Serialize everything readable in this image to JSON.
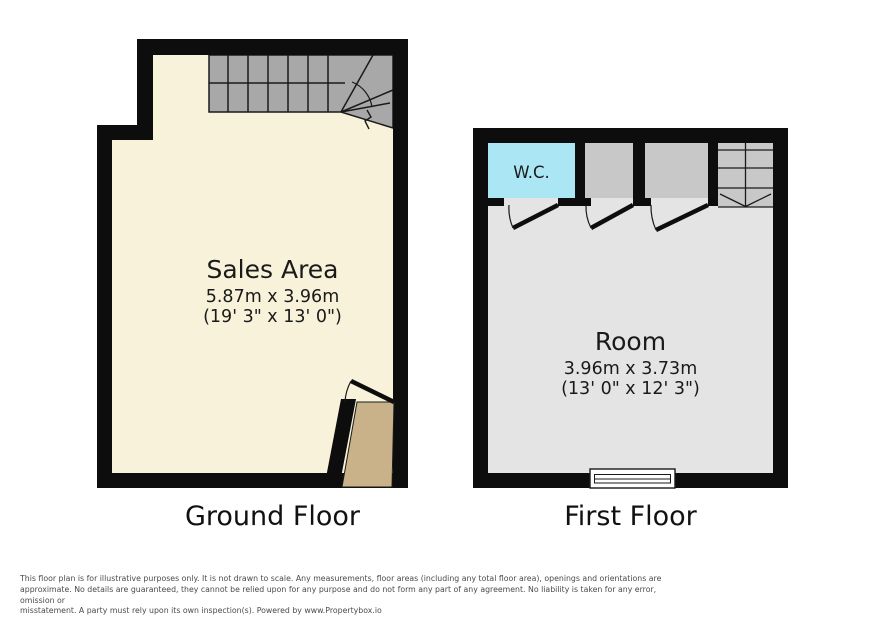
{
  "ground_floor": {
    "label": "Ground Floor",
    "room": {
      "name": "Sales Area",
      "dimensions_metric": "5.87m x 3.96m",
      "dimensions_imperial": "(19' 3\" x 13' 0\")"
    },
    "features": [
      "staircase-with-winder",
      "entrance-vestibule",
      "entrance-door"
    ]
  },
  "first_floor": {
    "label": "First Floor",
    "room": {
      "name": "Room",
      "dimensions_metric": "3.96m x 3.73m",
      "dimensions_imperial": "(13' 0\" x 12' 3\")"
    },
    "wc": {
      "label": "W.C."
    },
    "features": [
      "wc",
      "closet",
      "closet",
      "staircase-down",
      "window",
      "three-doors"
    ]
  },
  "disclaimer": {
    "line1": "This floor plan is for illustrative purposes only. It is not drawn to scale. Any measurements, floor areas (including any total floor area), openings and orientations are",
    "line2": "approximate. No details are guaranteed, they cannot be relied upon for any purpose and do not form any part of any agreement. No liability is taken for any error, omission or",
    "line3": "misstatement. A party must rely upon its own inspection(s). Powered by www.Propertybox.io"
  },
  "colors": {
    "wall": "#0d0d0d",
    "line": "#1a1a1a",
    "groundRoom": "#f8f2da",
    "groundStairs": "#a8a8a8",
    "vestibule": "#c9b189",
    "firstRoom": "#e4e4e4",
    "closet": "#c8c8c8",
    "firstStairs": "#c8c8c8",
    "wc": "#aae6f4",
    "disclaimerText": "#4a4a4a"
  }
}
